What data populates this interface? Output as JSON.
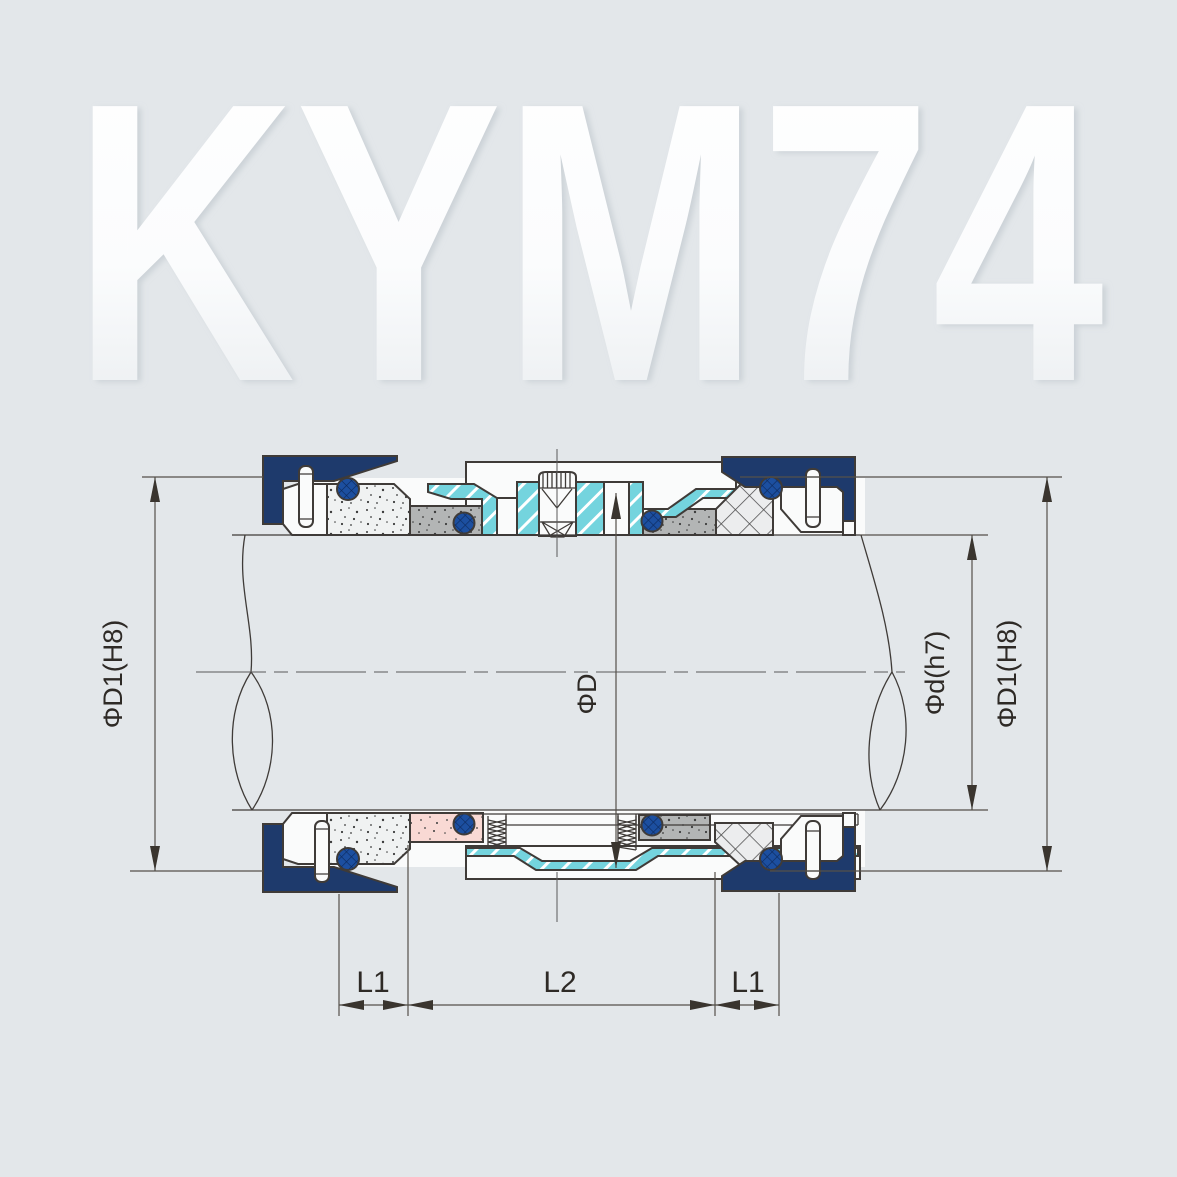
{
  "watermark": "KYM74",
  "labels": {
    "dia_D1_left": "ΦD1(H8)",
    "dia_D": "ΦD",
    "dia_d": "Φd(h7)",
    "dia_D1_right": "ΦD1(H8)",
    "len_L1_left": "L1",
    "len_L2": "L2",
    "len_L1_right": "L1"
  },
  "legend": {
    "drawing_type": "mechanical-seal-cross-section",
    "model": "KYM74"
  },
  "colors": {
    "background": "#e3e7ea",
    "outline": "#3f3b38",
    "dim_line": "#55504a",
    "arrow": "#3a352f",
    "navy": "#1e3a6c",
    "cyan": "#74d4de",
    "cyan_hatch": "#ffffff",
    "oring": "#1c4fa0",
    "oring_hatch": "#0d2a5e",
    "stip_w": "#f0f2f2",
    "stip_g": "#b3b5b5",
    "stip_p": "#f9d9d4",
    "speckle": "#3c3c3c",
    "packing": "#ecedee",
    "packing_line": "#4a4a4a",
    "white_part": "#fafbfb",
    "wm_top": "#ffffff",
    "wm_bottom": "#e6eaed",
    "wm_shadow": "#b9c1c8"
  }
}
